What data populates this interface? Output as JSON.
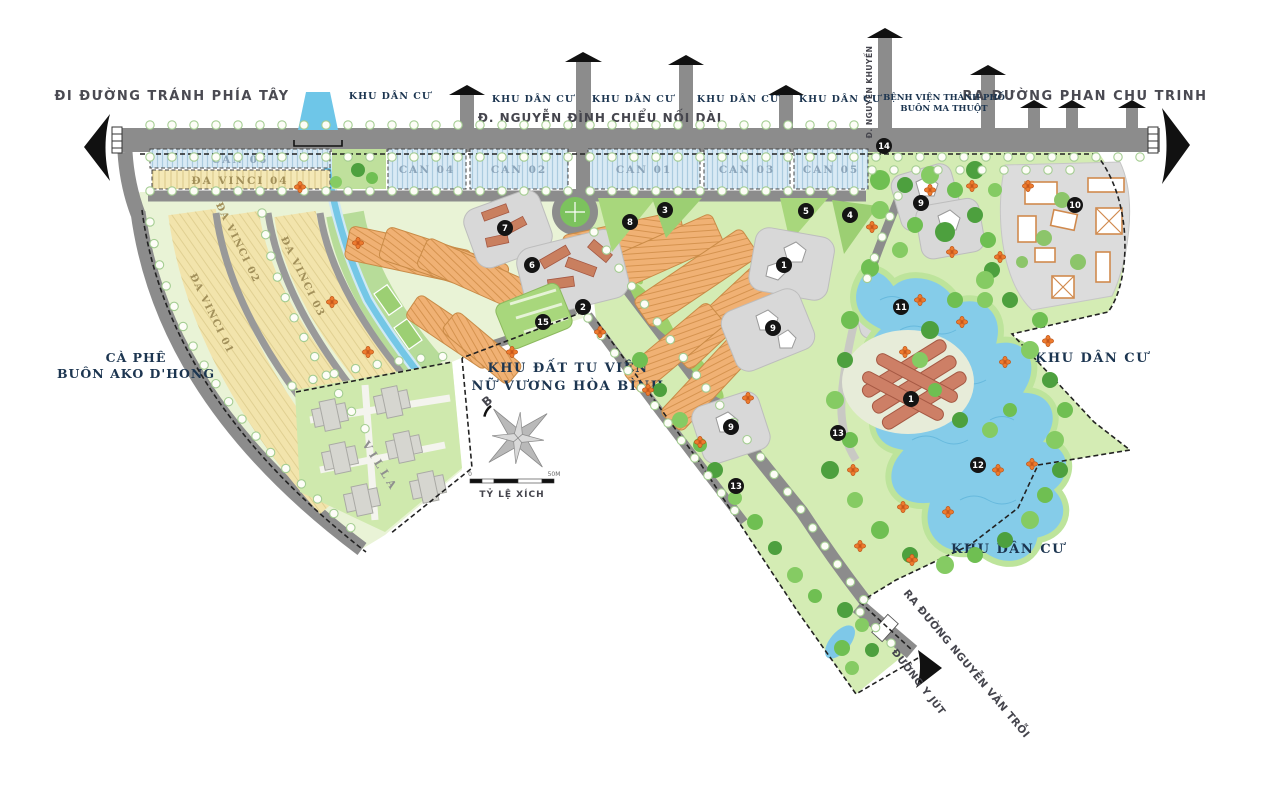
{
  "map": {
    "labels": {
      "exit_west": "ĐI ĐƯỜNG TRÁNH PHÍA TÂY",
      "exit_east": "RA ĐƯỜNG PHAN CHU TRINH",
      "main_road": "Đ. NGUYỄN ĐÌNH CHIỂU NỐI DÀI",
      "road_vertical": "Đ. NGUYỄN KHUYẾN",
      "hospital": [
        "BỆNH VIỆN THÀNH PHỐ",
        "BUÔN MA THUỘT"
      ],
      "residential": "KHU DÂN CƯ",
      "coffee": [
        "CÀ PHÊ",
        "BUÔN AKO D'HONG"
      ],
      "convent": [
        "KHU ĐẤT TU VIỆN",
        "NỮ VƯƠNG HÒA BÌNH"
      ],
      "exit_southeast": "RA ĐƯỜNG NGUYỄN VĂN TRỖI",
      "road_yjut": "ĐƯỜNG Y JÚT",
      "villa": "VILLA",
      "compass_north": "B",
      "scale_label": "TỶ LỆ XÍCH",
      "scale_ticks": [
        "0",
        "50M"
      ]
    },
    "parcels": {
      "can": [
        "CAN 06",
        "CAN 04",
        "CAN 02",
        "CAN 01",
        "CAN 03",
        "CAN 05"
      ],
      "davinci": [
        "ĐA VINCI 04",
        "ĐA VINCI 02",
        "ĐA VINCI 03",
        "ĐA VINCI 01"
      ]
    },
    "markers": [
      {
        "n": "14",
        "x": 884,
        "y": 146
      },
      {
        "n": "7",
        "x": 505,
        "y": 228
      },
      {
        "n": "8",
        "x": 630,
        "y": 222
      },
      {
        "n": "3",
        "x": 665,
        "y": 210
      },
      {
        "n": "5",
        "x": 806,
        "y": 211
      },
      {
        "n": "4",
        "x": 850,
        "y": 215
      },
      {
        "n": "9",
        "x": 921,
        "y": 203
      },
      {
        "n": "10",
        "x": 1075,
        "y": 205
      },
      {
        "n": "6",
        "x": 532,
        "y": 265
      },
      {
        "n": "1",
        "x": 784,
        "y": 265
      },
      {
        "n": "2",
        "x": 583,
        "y": 307
      },
      {
        "n": "15",
        "x": 543,
        "y": 322
      },
      {
        "n": "9",
        "x": 773,
        "y": 328
      },
      {
        "n": "11",
        "x": 901,
        "y": 307
      },
      {
        "n": "1",
        "x": 911,
        "y": 399
      },
      {
        "n": "13",
        "x": 838,
        "y": 433
      },
      {
        "n": "9",
        "x": 731,
        "y": 427
      },
      {
        "n": "12",
        "x": 978,
        "y": 465
      },
      {
        "n": "13",
        "x": 736,
        "y": 486
      }
    ],
    "colors": {
      "road": "#8c8c8c",
      "water": "#7ec8e8",
      "park_green": "#d4ecb4",
      "canopy_green": "#5fae49",
      "can_parcel": "#d9eaf5",
      "davinci_parcel": "#f2e4ac",
      "townhouse": "#f0b174",
      "terracotta_building": "#cd7f66",
      "flower": "#ed7a2e",
      "marker": "#141414",
      "label_navy": "#1c3550",
      "label_gray": "#45454d",
      "boundary": "#222222"
    }
  }
}
